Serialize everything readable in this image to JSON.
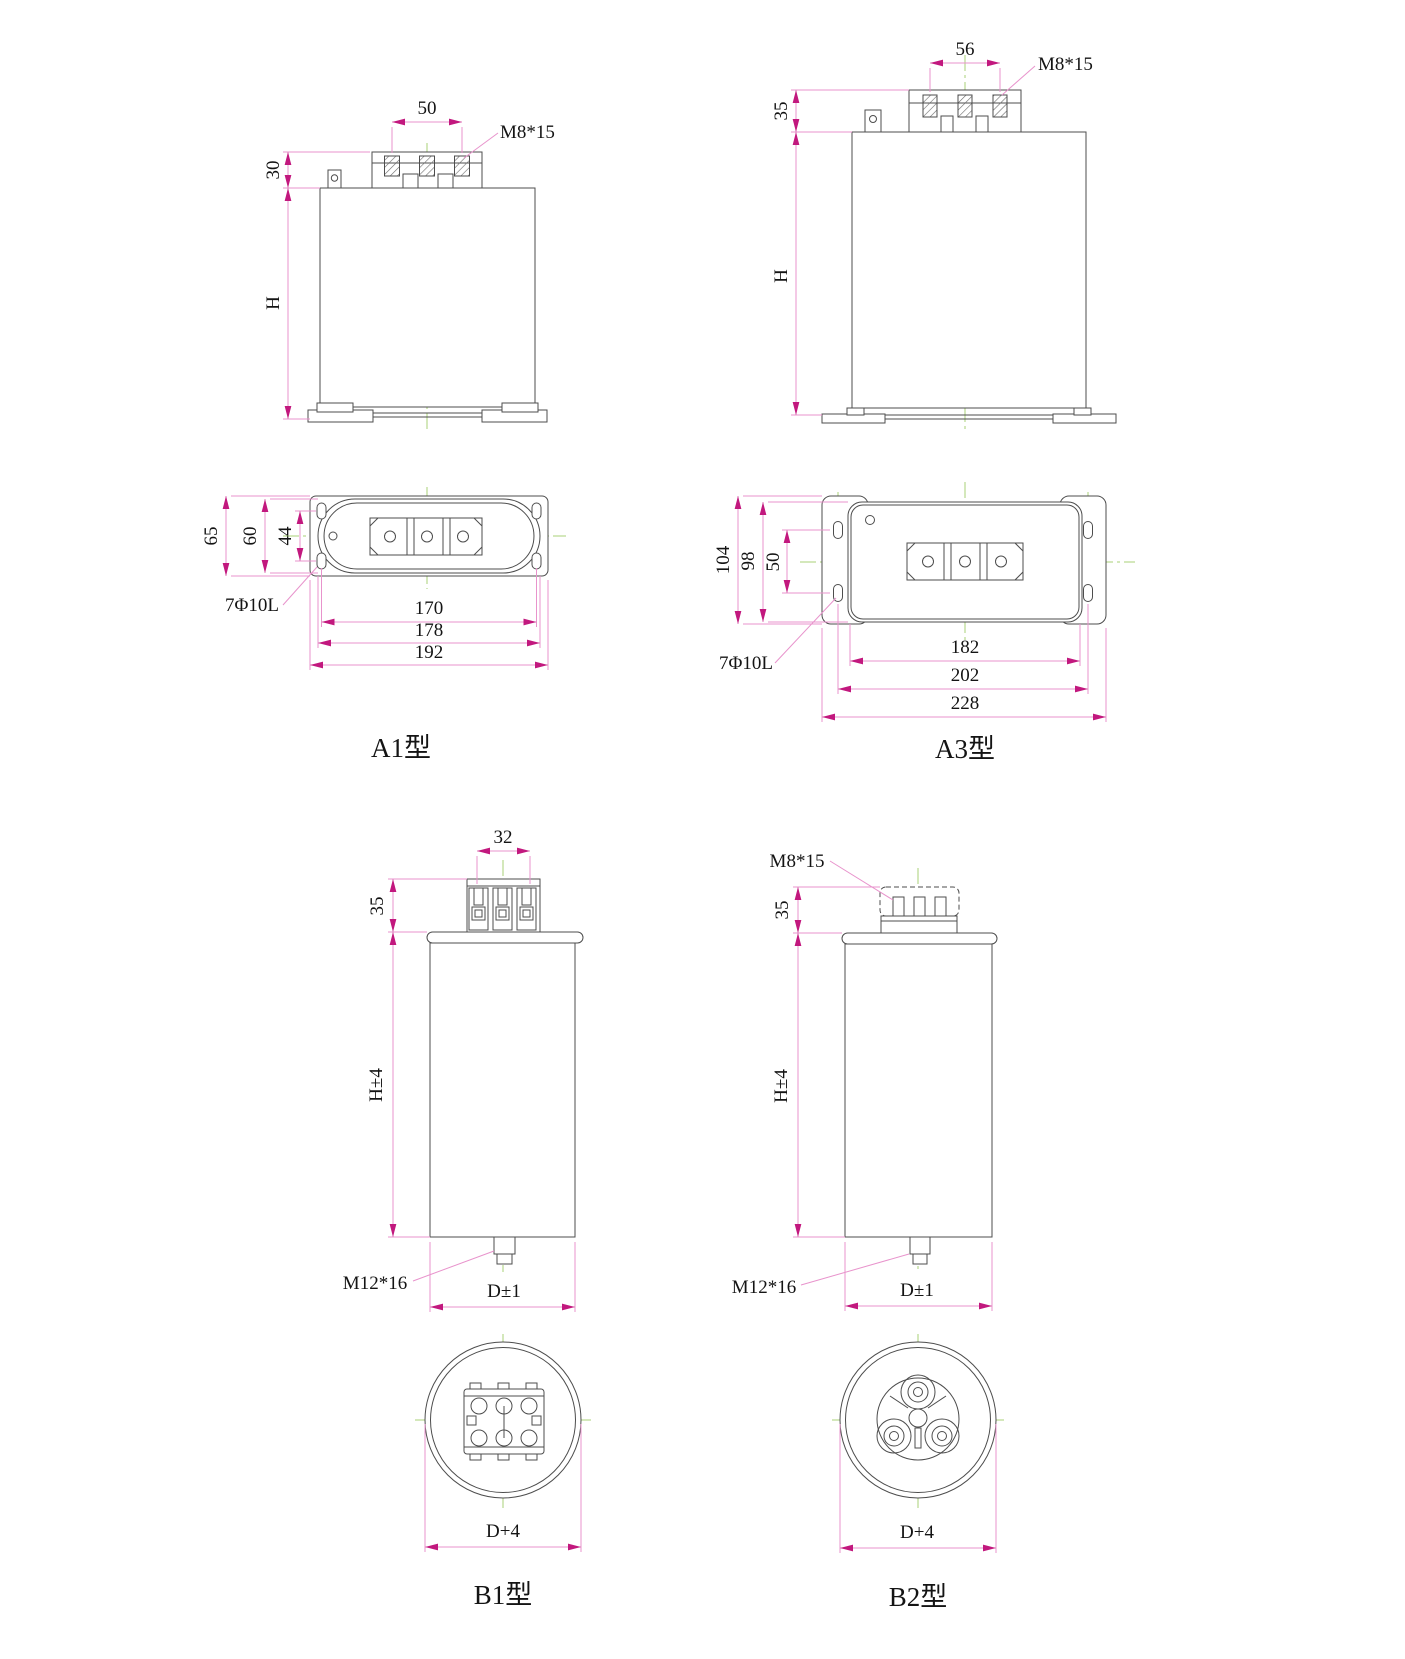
{
  "drawing": {
    "a1": {
      "caption": "A1型",
      "side": {
        "terminal_pitch": "50",
        "terminal_thread": "M8*15",
        "head_height": "30",
        "body_height": "H"
      },
      "top": {
        "flange_depth": "65",
        "body_depth": "60",
        "slot_pitch_v": "44",
        "mount_hole_note": "7Φ10L",
        "slot_pitch_h": "170",
        "body_width": "178",
        "flange_width": "192"
      }
    },
    "a3": {
      "caption": "A3型",
      "side": {
        "terminal_pitch": "56",
        "terminal_thread": "M8*15",
        "head_height": "35",
        "body_height": "H"
      },
      "top": {
        "flange_depth": "104",
        "body_depth": "98",
        "slot_pitch_v": "50",
        "mount_hole_note": "7Φ10L",
        "body_width": "182",
        "slot_pitch_h": "202",
        "flange_width": "228"
      }
    },
    "b1": {
      "caption": "B1型",
      "side": {
        "terminal_pitch": "32",
        "head_height": "35",
        "body_height": "H±4",
        "bottom_stud": "M12*16",
        "diameter": "D±1"
      },
      "top": {
        "overall_diameter": "D+4"
      }
    },
    "b2": {
      "caption": "B2型",
      "side": {
        "terminal_thread": "M8*15",
        "head_height": "35",
        "body_height": "H±4",
        "bottom_stud": "M12*16",
        "diameter": "D±1"
      },
      "top": {
        "overall_diameter": "D+4"
      }
    },
    "colors": {
      "outline": "#4d4d4d",
      "dimension_line": "#e893cc",
      "dimension_arrow": "#c2187e",
      "centerline": "#a9d177",
      "text": "#141414"
    }
  }
}
